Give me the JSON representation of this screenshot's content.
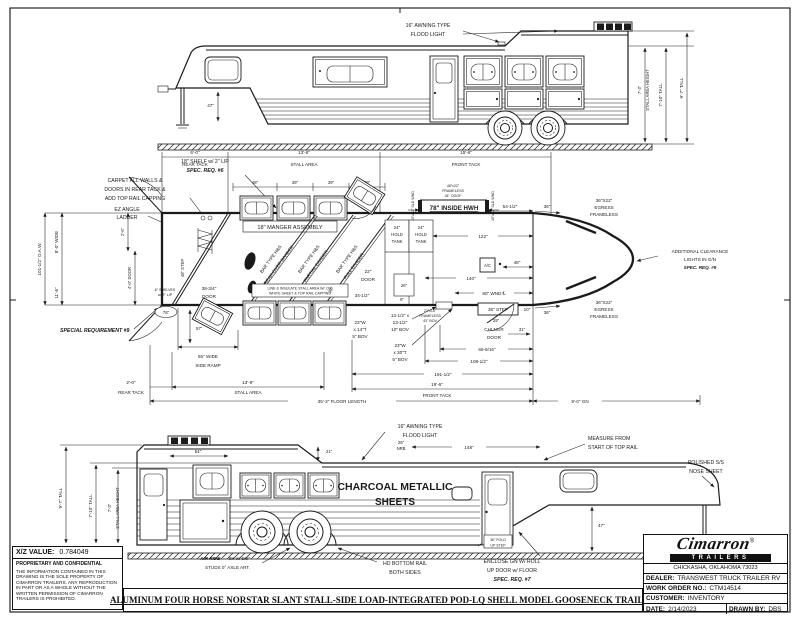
{
  "sheet": {
    "xz": {
      "label": "X/Z VALUE:",
      "value": "0.784049"
    },
    "confidential": {
      "title": "PROPRIETARY AND CONFIDENTIAL",
      "body": "THE INFORMATION CONTAINED IN THIS DRAWING IS THE SOLE PROPERTY OF CIMARRON TRAILERS.  ANY REPRODUCTION IN PART OR AS A WHOLE WITHOUT THE WRITTEN PERMISSION OF CIMARRON TRAILERS IS PROHIBITED."
    },
    "title": "ALUMINUM FOUR HORSE NORSTAR SLANT STALL-SIDE LOAD-INTEGRATED POD-LQ SHELL MODEL GOOSENECK TRAILER",
    "brand": {
      "name": "Cimarron",
      "sub": "TRAILERS",
      "reg": "®",
      "address": "CHICKASHA, OKLAHOMA 73023"
    },
    "fields": {
      "dealer_label": "DEALER:",
      "dealer": "TRANSWEST TRUCK TRAILER RV",
      "wo_label": "WORK ORDER NO.:",
      "wo": "CTM14514",
      "customer_label": "CUSTOMER:",
      "customer": "INVENTORY",
      "date_label": "DATE:",
      "date": "2/14/2023",
      "drawn_label": "DRAWN BY:",
      "drawn": "DBS"
    }
  },
  "top_view": {
    "flood_light": [
      "16\" AWNING TYPE",
      "FLOOD LIGHT"
    ],
    "dim_47": "47\"",
    "stall_height": [
      "7'-3\"",
      "STALL AREA HEIGHT"
    ],
    "tall_7_10": "7'-10\" TALL",
    "tall_9_7": "9'-7\" TALL"
  },
  "plan": {
    "shelf_note": [
      "18\" SHELF w/ 2\" LIP",
      "SPEC. REQ. #6"
    ],
    "carpet_note": [
      "CARPET ALL WALLS &",
      "DOORS IN REAR TACK &",
      "ADD TOP RAIL CAPPING"
    ],
    "ladder_note": [
      "EZ ANGLE",
      "LADDER"
    ],
    "dim_rear_tack_top": [
      "6'-0\"",
      "REAR TACK"
    ],
    "dim_stall_top": [
      "13'-9\"",
      "STALL AREA"
    ],
    "dim_front_tack_top": [
      "15'-6\"",
      "FRONT TACK"
    ],
    "manger_dims": [
      "48\"",
      "39\"",
      "39\"",
      "39\""
    ],
    "manger_assembly": "18\" MANGER ASSEMBLY",
    "ogof_note": [
      "48\"x22\"",
      "FRAMELESS",
      "34\" OGOF"
    ],
    "sld_wnd": "15\"x22\" SLD WND",
    "inside_hwh": "78\" INSIDE HWH",
    "dim_54_5": "54-1/2\"",
    "dim_36": "36\"",
    "egress_note": [
      "36\"X22\"",
      "EGRESS",
      "FRAMELESS"
    ],
    "clearance_note": [
      "ADDITIONAL CLEARANCE",
      "LIGHTS IN G/N",
      "SPEC. REQ. #9"
    ],
    "tank_note": [
      "24\"",
      "HOLD",
      "TANK"
    ],
    "dim_122": "122\"",
    "ac": "A/C",
    "dim_48": "48\"",
    "dim_140": "140\"",
    "dim_wnd_80": "80\" WND ℄",
    "dim_26": "26\"",
    "dim_oaw": "101-1/2\" O.A.W.",
    "dim_wide": "8'-0\" WIDE",
    "dim_2_6": "2'-6\"",
    "dim_door_4": "4'-0\" DOOR",
    "step_48": "48\" STEP",
    "dim_11_6": "11'-6\"",
    "special_req": "SPECIAL REQUIREMENT #9",
    "shelves_note": [
      "6\" SHELVES",
      "w/ 2\" LIP"
    ],
    "door_3834": [
      "38-3/4\"",
      "DOOR"
    ],
    "oval_78": "78\"",
    "dim_57": "57\"",
    "ramp_note": [
      "65\" WIDE",
      "SIDE RAMP"
    ],
    "divider_1": [
      "BAR TYPE H&S",
      "BREAK-OVER DIVIDER"
    ],
    "divider_2": [
      "BAR TYPE H&S",
      "PARTIAL DIVIDER"
    ],
    "divider_3": [
      "BAR TYPE H&S",
      "FULL DIVIDER"
    ],
    "liner_note": [
      "LINE & INSULATE STALL AREA W/ .090",
      "WHITE SHEET & TOP RAIL CAPPING"
    ],
    "door_22": [
      "22\"",
      "DOOR"
    ],
    "dim_34_5": "34-1/2\"",
    "dim_6": "6\"",
    "bov_23_14": [
      "23\"W",
      "x 14\"T",
      "5\" BOV"
    ],
    "bov_13": [
      "13-1/2\" x",
      "13-1/2\"",
      "10\" BOV"
    ],
    "bov_22_15": [
      "22\"x15\"",
      "FRAMELESS",
      "43\" BOV"
    ],
    "bov_23_30": [
      "23\"W",
      "x 30\"T",
      "5\" BOV"
    ],
    "step_36": "36\" STEP",
    "dim_10": "10\"",
    "chlngr": [
      "29\"",
      "CHLNGR",
      "DOOR"
    ],
    "dim_31": "31\"",
    "dim_66": "66-9/16\"",
    "dim_108": "108-1/2\"",
    "dim_191": "191-1/2\"",
    "dim_front_tack_bottom": [
      "19'-6\"",
      "FRONT TACK"
    ],
    "dim_rear_tack_bottom": [
      "2'-0\"",
      "REAR TACK"
    ],
    "dim_stall_bottom": [
      "13'-9\"",
      "STALL AREA"
    ],
    "dim_floor": "35'-3\" FLOOR LENGTH",
    "dim_gn": "9'-0\" GN"
  },
  "bottom_view": {
    "flood_light": [
      "16\" AWNING TYPE",
      "FLOOD LIGHT"
    ],
    "dim_54": "54\"",
    "dim_21": "21\"",
    "nrb": [
      "26\"",
      "NRB"
    ],
    "dim_148": "148\"",
    "measure_note": [
      "MEASURE FROM",
      "START OF TOP RAIL"
    ],
    "nose_note": [
      "POLISHED S/S",
      "NOSE SHEET"
    ],
    "charcoal": [
      "CHARCOAL METALLIC",
      "SHEETS"
    ],
    "dim_47": "47\"",
    "fold_step": [
      "36\" FOLD",
      "UP STEP"
    ],
    "enclose_note": [
      "ENCLOSE GN W/ ROLL",
      "UP DOOR w/ FLOOR",
      "SPEC. REQ. #7"
    ],
    "air_ride_bold": "AIR RIDE",
    "air_ride_rest": "- 9K w/ 5/8\"",
    "air_ride_2": "STUDS 0° AXLE ART.",
    "rail_note": [
      "HD BOTTOM RAIL",
      "BOTH SIDES"
    ],
    "stall_height": [
      "7'-3\"",
      "STALL AREA HEIGHT"
    ],
    "tall_7_10": "7'-10\" TALL",
    "tall_9_7": "9'-7\" TALL"
  }
}
